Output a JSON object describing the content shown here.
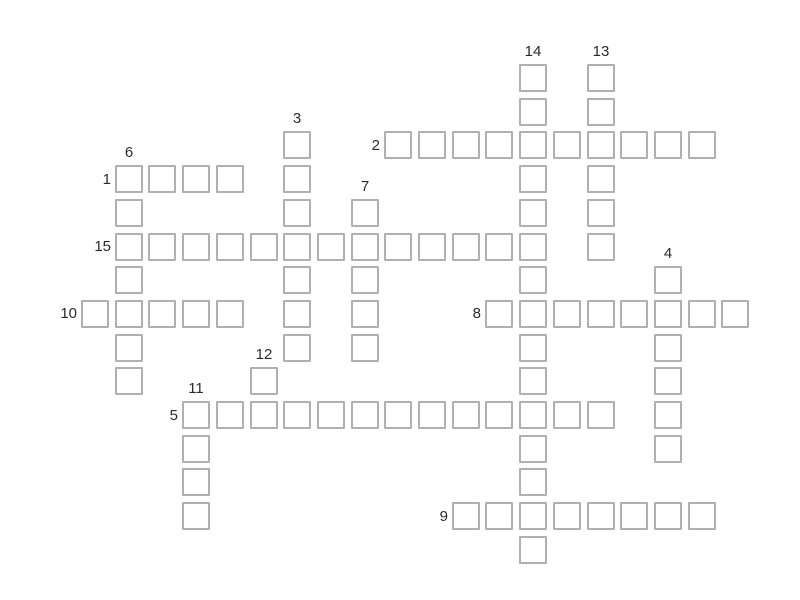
{
  "page": {
    "background_color": "#ffffff"
  },
  "crossword": {
    "cell_border_color": "#b0b0b0",
    "cell_fill_color": "#ffffff",
    "label_color": "#2b2b2b",
    "clue_numbers_visible": [
      "1",
      "2",
      "3",
      "4",
      "5",
      "6",
      "7",
      "8",
      "9",
      "10",
      "11",
      "12",
      "13",
      "14",
      "15"
    ],
    "cells_empty": true,
    "words": [
      {
        "number": "1",
        "direction": "across",
        "row": 3,
        "col": 1,
        "length": 4
      },
      {
        "number": "2",
        "direction": "across",
        "row": 2,
        "col": 9,
        "length": 10
      },
      {
        "number": "3",
        "direction": "down",
        "row": 2,
        "col": 6,
        "length": 7
      },
      {
        "number": "4",
        "direction": "down",
        "row": 6,
        "col": 17,
        "length": 6
      },
      {
        "number": "5",
        "direction": "across",
        "row": 10,
        "col": 3,
        "length": 13
      },
      {
        "number": "6",
        "direction": "down",
        "row": 3,
        "col": 1,
        "length": 7
      },
      {
        "number": "7",
        "direction": "down",
        "row": 4,
        "col": 8,
        "length": 5
      },
      {
        "number": "8",
        "direction": "across",
        "row": 7,
        "col": 12,
        "length": 8
      },
      {
        "number": "9",
        "direction": "across",
        "row": 13,
        "col": 11,
        "length": 8
      },
      {
        "number": "10",
        "direction": "across",
        "row": 7,
        "col": 0,
        "length": 5
      },
      {
        "number": "11",
        "direction": "down",
        "row": 10,
        "col": 3,
        "length": 4
      },
      {
        "number": "12",
        "direction": "down",
        "row": 9,
        "col": 5,
        "length": 2
      },
      {
        "number": "13",
        "direction": "down",
        "row": 0,
        "col": 15,
        "length": 6
      },
      {
        "number": "14",
        "direction": "down",
        "row": 0,
        "col": 13,
        "length": 15
      },
      {
        "number": "15",
        "direction": "across",
        "row": 5,
        "col": 1,
        "length": 13
      }
    ]
  }
}
